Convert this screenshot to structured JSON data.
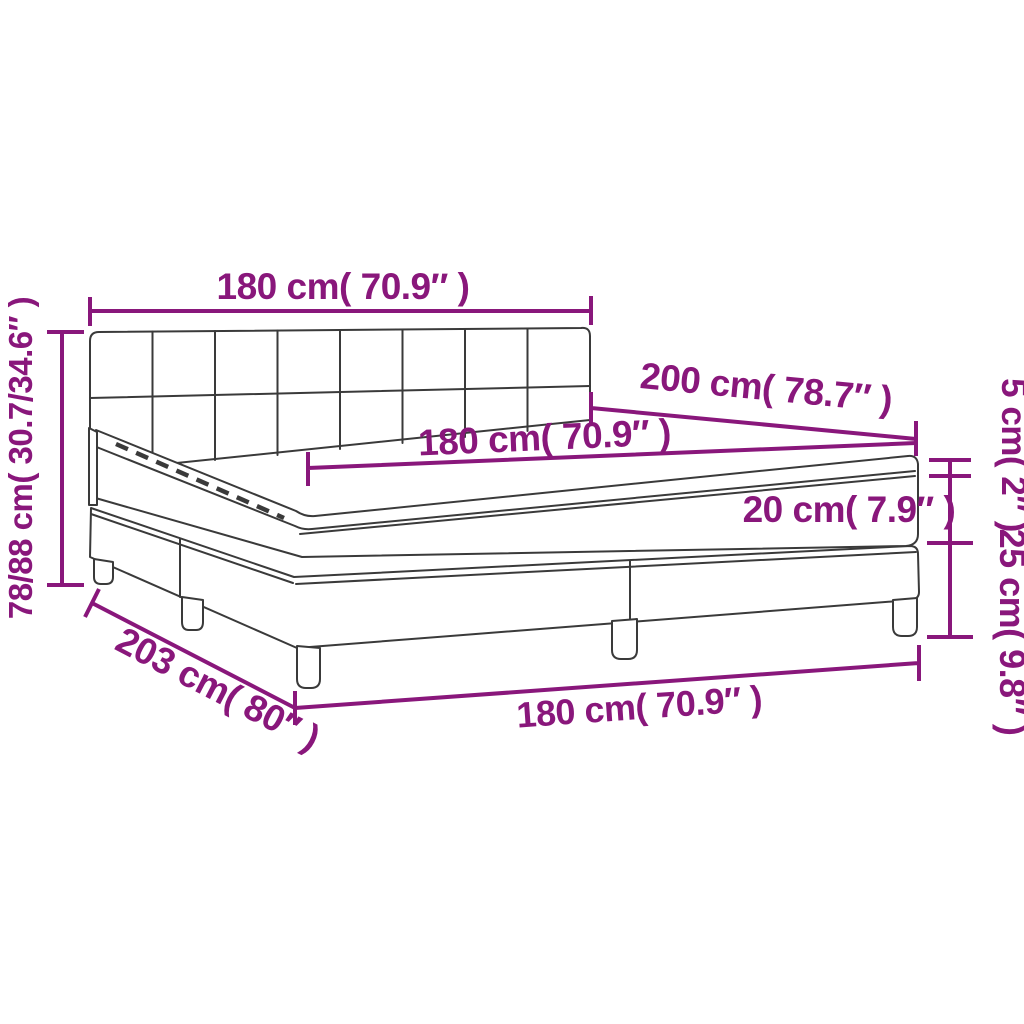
{
  "figure": {
    "type": "product-dimension-diagram",
    "subject": "box spring bed with tufted headboard, mattress and topper",
    "background_color": "#ffffff",
    "line_color": "#3a3a3a",
    "dimension_color": "#89177B",
    "labels": {
      "headboard_width": "180 cm( 70.9″ )",
      "total_height": "78/88 cm( 30.7/34.6″ )",
      "bed_length": "200 cm( 78.7″ )",
      "mattress_width": "180 cm( 70.9″ )",
      "topper_height": "5 cm( 2″ )",
      "mattress_height": "20 cm( 7.9″ )",
      "base_height": "25 cm( 9.8″ )",
      "frame_length": "203 cm( 80″ )",
      "base_width": "180 cm( 70.9″ )"
    }
  }
}
